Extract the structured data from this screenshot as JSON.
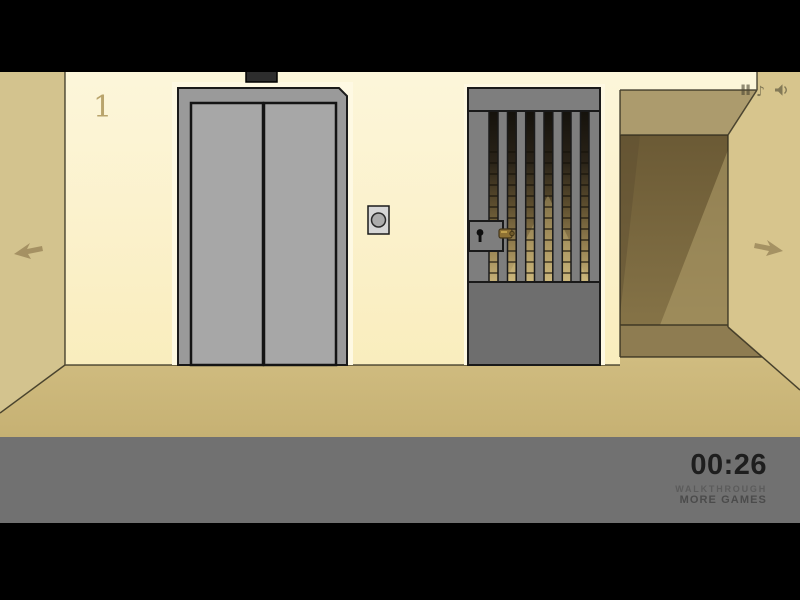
{
  "hud": {
    "floor_number": "1",
    "timer": "00:26",
    "walkthrough_label": "WALKTHROUGH",
    "more_games_label": "MORE GAMES"
  },
  "icons": {
    "pause": "pause-icon",
    "music": "music-note-icon",
    "music_glyph": "♪",
    "sound": "speaker-icon",
    "nav_left": "left-arrow-icon",
    "nav_right": "right-arrow-icon",
    "elevator_call": "elevator-call-button",
    "keyhole": "keyhole-icon"
  },
  "colors": {
    "letterbox": "#000000",
    "wall_top": "#FCF6DA",
    "wall_bottom": "#F9EDBD",
    "wall_highlight": "#FEF9E3",
    "side_wall_left": "#D3C38E",
    "side_wall_right": "#D7C58D",
    "floor_top": "#D0BC80",
    "floor_bottom": "#C6B173",
    "corridor_band": "#AC9B6D",
    "corridor_dark": "#766439",
    "corridor_shadow": "#8E7C51",
    "elevator_frame": "#9A9A9A",
    "elevator_door": "#A7A7A7",
    "gate_gray": "#7E7E7E",
    "gate_panel": "#6E6E6E",
    "latch_gold": "#8E7134",
    "hud_bar": "#717171",
    "timer_text": "#1E1E1E"
  }
}
